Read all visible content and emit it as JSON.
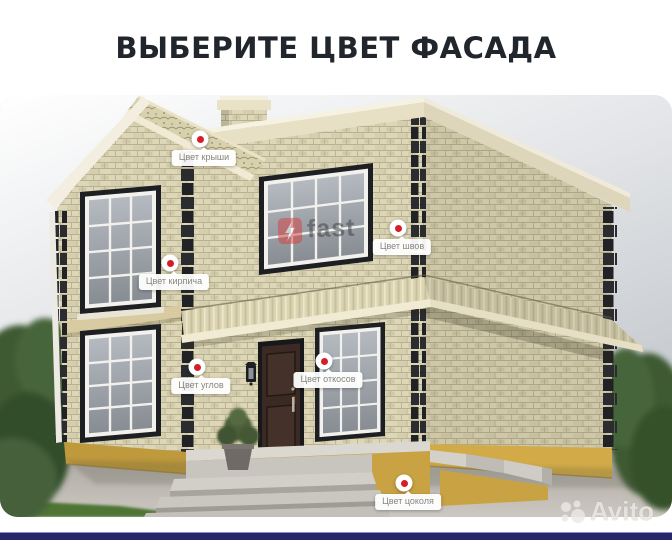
{
  "header": {
    "title": "ВЫБЕРИТЕ ЦВЕТ ФАСАДА"
  },
  "hotspots": [
    {
      "id": "roof",
      "label": "Цвет крыши"
    },
    {
      "id": "brick",
      "label": "Цвет кирпича"
    },
    {
      "id": "seams",
      "label": "Цвет швов"
    },
    {
      "id": "corners",
      "label": "Цвет углов"
    },
    {
      "id": "reveals",
      "label": "Цвет откосов"
    },
    {
      "id": "plinth",
      "label": "Цвет цоколя"
    }
  ],
  "watermarks": {
    "brand": "fast",
    "platform": "Avito"
  },
  "colors": {
    "title_text": "#21252c",
    "marker_dot": "#d41f26",
    "label_text": "#85857f",
    "bottom_bar": "#26266b",
    "brick_wall": "#ddd7b8",
    "quoins": "#2a2c2f",
    "plinth": "#c7a03f"
  }
}
